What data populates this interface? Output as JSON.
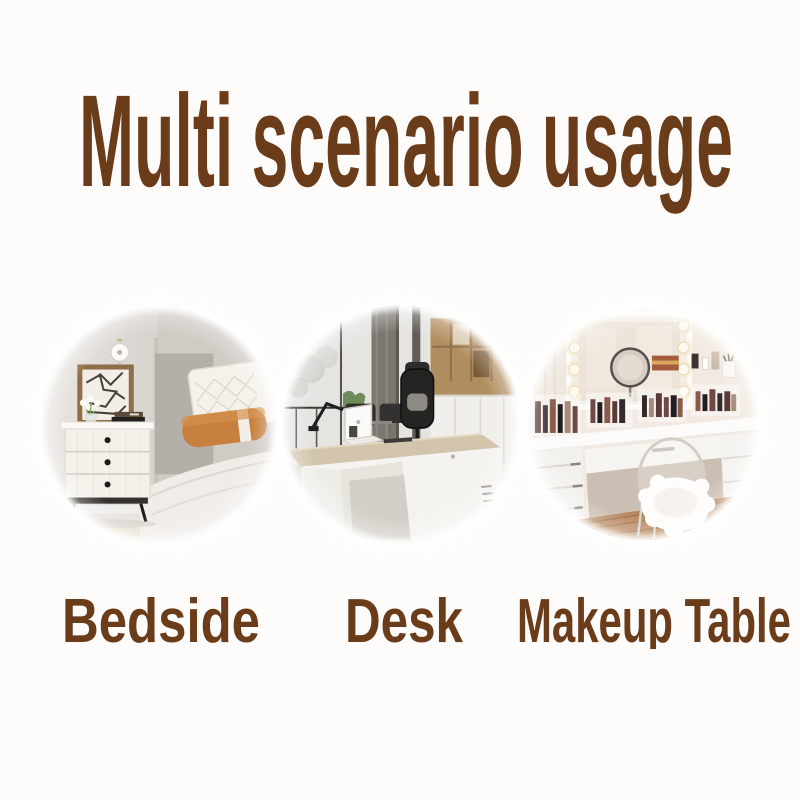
{
  "page": {
    "background_color": "#fdfcfa",
    "accent_color": "#6b3c1a"
  },
  "title": "Multi scenario usage",
  "scenarios": [
    {
      "label": "Bedside",
      "image_alt": "white three-drawer nightstand with framed art, flowers and books beside a bed with white pillow and orange bolster"
    },
    {
      "label": "Desk",
      "image_alt": "modern executive office desk with white laptop, black chair, concrete window pillars and wooden shelving"
    },
    {
      "label": "Makeup Table",
      "image_alt": "white vanity makeup table with lighted hollywood mirror, acrylic makeup organizers and clear ghost chair with white fur"
    }
  ]
}
